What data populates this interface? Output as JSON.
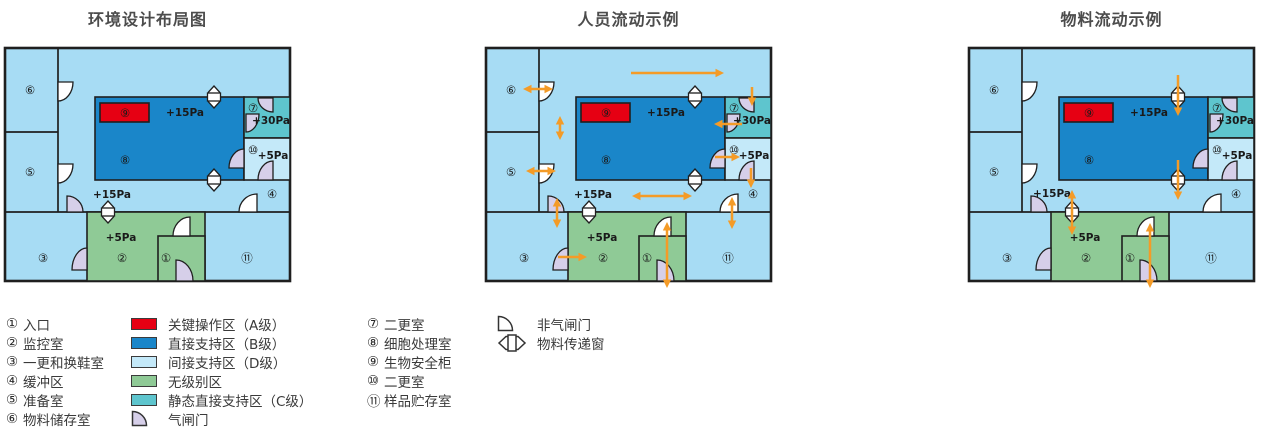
{
  "diagrams": [
    {
      "title": "环境设计布局图",
      "arrows": [],
      "overrides": {}
    },
    {
      "title": "人员流动示例",
      "arrows": [
        [
          145,
          25,
          238,
          25,
          "end"
        ],
        [
          37,
          41,
          67,
          41,
          "both"
        ],
        [
          74,
          68,
          74,
          92,
          "both"
        ],
        [
          40,
          123,
          70,
          123,
          "both"
        ],
        [
          266,
          39,
          266,
          58,
          "end"
        ],
        [
          256,
          76,
          228,
          76,
          "end"
        ],
        [
          229,
          109,
          254,
          109,
          "end"
        ],
        [
          265,
          120,
          265,
          140,
          "end"
        ],
        [
          146,
          148,
          206,
          148,
          "both"
        ],
        [
          71,
          150,
          71,
          180,
          "both"
        ],
        [
          72,
          209,
          101,
          209,
          "end"
        ],
        [
          181,
          174,
          181,
          240,
          "both"
        ],
        [
          246,
          149,
          246,
          181,
          "both"
        ]
      ],
      "overrides": {}
    },
    {
      "title": "物料流动示例",
      "arrows": [
        [
          209,
          27,
          209,
          68,
          "end"
        ],
        [
          209,
          112,
          209,
          152,
          "end"
        ],
        [
          103,
          142,
          103,
          187,
          "both"
        ],
        [
          181,
          175,
          181,
          240,
          "both"
        ]
      ],
      "overrides": {
        "pcorr": {
          "x": 83,
          "y": 146
        }
      }
    }
  ],
  "colors": {
    "red": "#e60013",
    "blue": "#1a86c9",
    "lightblue": "#a7dcf4",
    "paleblue": "#c4e9f9",
    "green": "#8fca96",
    "teal": "#5ec5ce",
    "airlock": "#d6cfe9",
    "plain": "#ffffff",
    "orange": "#f49b27",
    "line": "#1f1f1f",
    "text": "#1a1a1a"
  },
  "floorplan": {
    "base": {
      "w": 285,
      "h": 233
    },
    "walls": [
      [
        53,
        0,
        53,
        164
      ],
      [
        0,
        84,
        53,
        84
      ],
      [
        0,
        164,
        285,
        164
      ]
    ],
    "zones": [
      {
        "name": "room-2-monitoring",
        "x": 82,
        "y": 164,
        "w": 118,
        "h": 69,
        "fill": "green"
      },
      {
        "name": "room-1-entrance",
        "x": 153,
        "y": 188,
        "w": 47,
        "h": 45,
        "fill": "green"
      },
      {
        "name": "room-8-cell-processing",
        "x": 90,
        "y": 49,
        "w": 149,
        "h": 83,
        "fill": "blue"
      },
      {
        "name": "room-7-second-change",
        "x": 239,
        "y": 49,
        "w": 46,
        "h": 41,
        "fill": "teal"
      },
      {
        "name": "room-10-second-change",
        "x": 239,
        "y": 90,
        "w": 46,
        "h": 42,
        "fill": "paleblue"
      },
      {
        "name": "biosafety-cabinet-9",
        "x": 95,
        "y": 55,
        "w": 49,
        "h": 19,
        "fill": "red"
      }
    ],
    "doors": [
      {
        "name": "door-room6",
        "x": 53,
        "y": 34,
        "w": 15,
        "h": 19,
        "hinge": "tl",
        "type": "plain"
      },
      {
        "name": "door-room5",
        "x": 53,
        "y": 116,
        "w": 15,
        "h": 19,
        "hinge": "tl",
        "type": "plain"
      },
      {
        "name": "door-corridor-room3",
        "x": 62,
        "y": 148,
        "w": 16,
        "h": 16,
        "hinge": "bl",
        "type": "airlock"
      },
      {
        "name": "door-room8-room10",
        "x": 224,
        "y": 101,
        "w": 15,
        "h": 19,
        "hinge": "br",
        "type": "airlock"
      },
      {
        "name": "door-room7-top",
        "x": 253,
        "y": 50,
        "w": 15,
        "h": 14,
        "hinge": "tr",
        "type": "airlock"
      },
      {
        "name": "door-room7-left",
        "x": 241,
        "y": 66,
        "w": 13,
        "h": 18,
        "hinge": "tl",
        "type": "airlock"
      },
      {
        "name": "door-room10",
        "x": 253,
        "y": 113,
        "w": 15,
        "h": 19,
        "hinge": "br",
        "type": "airlock"
      },
      {
        "name": "door-corridor-room11",
        "x": 234,
        "y": 146,
        "w": 18,
        "h": 18,
        "hinge": "br",
        "type": "plain"
      },
      {
        "name": "door-room3-room2",
        "x": 67,
        "y": 200,
        "w": 15,
        "h": 22,
        "hinge": "br",
        "type": "airlock"
      },
      {
        "name": "door-room1-top",
        "x": 168,
        "y": 169,
        "w": 17,
        "h": 19,
        "hinge": "br",
        "type": "plain"
      },
      {
        "name": "door-room1-bottom",
        "x": 171,
        "y": 212,
        "w": 17,
        "h": 21,
        "hinge": "bl",
        "type": "airlock"
      }
    ],
    "windows": [
      {
        "name": "pass-window-room8-top",
        "cx": 209,
        "cy": 49
      },
      {
        "name": "pass-window-room8-bottom",
        "cx": 209,
        "cy": 132
      },
      {
        "name": "pass-window-room2",
        "cx": 103,
        "cy": 164
      }
    ],
    "room_numbers": [
      {
        "t": "⑥",
        "x": 25,
        "y": 42
      },
      {
        "t": "⑤",
        "x": 25,
        "y": 124
      },
      {
        "t": "③",
        "x": 38,
        "y": 210
      },
      {
        "t": "②",
        "x": 117,
        "y": 210
      },
      {
        "t": "①",
        "x": 161,
        "y": 210
      },
      {
        "t": "⑪",
        "x": 242,
        "y": 210
      },
      {
        "t": "⑧",
        "x": 120,
        "y": 112
      },
      {
        "t": "⑨",
        "x": 120,
        "y": 65
      },
      {
        "t": "⑦",
        "x": 248,
        "y": 60
      },
      {
        "t": "⑩",
        "x": 248,
        "y": 102
      },
      {
        "t": "④",
        "x": 267,
        "y": 146
      }
    ],
    "pressures": [
      {
        "id": "p8",
        "t": "+15Pa",
        "x": 180,
        "y": 65
      },
      {
        "id": "p7",
        "t": "+30Pa",
        "x": 266,
        "y": 73
      },
      {
        "id": "p10",
        "t": "+5Pa",
        "x": 268,
        "y": 108
      },
      {
        "id": "pcorr",
        "t": "+15Pa",
        "x": 107,
        "y": 147
      },
      {
        "id": "p2",
        "t": "+5Pa",
        "x": 116,
        "y": 190
      }
    ]
  },
  "legend": {
    "rooms_col1": [
      {
        "num": "①",
        "label": "入口"
      },
      {
        "num": "②",
        "label": "监控室"
      },
      {
        "num": "③",
        "label": "一更和换鞋室"
      },
      {
        "num": "④",
        "label": "缓冲区"
      },
      {
        "num": "⑤",
        "label": "准备室"
      },
      {
        "num": "⑥",
        "label": "物料储存室"
      }
    ],
    "zones": [
      {
        "swatch": "red",
        "label": "关键操作区（A级）"
      },
      {
        "swatch": "blue",
        "label": "直接支持区（B级）"
      },
      {
        "swatch": "paleblue",
        "label": "间接支持区（D级）"
      },
      {
        "swatch": "green",
        "label": "无级别区"
      },
      {
        "swatch": "teal",
        "label": "静态直接支持区（C级）"
      },
      {
        "icon": "airlock-door",
        "label": "气闸门"
      }
    ],
    "rooms_col2": [
      {
        "num": "⑦",
        "label": "二更室"
      },
      {
        "num": "⑧",
        "label": "细胞处理室"
      },
      {
        "num": "⑨",
        "label": "生物安全柜"
      },
      {
        "num": "⑩",
        "label": "二更室"
      },
      {
        "num": "⑪",
        "label": "样品贮存室"
      }
    ],
    "symbols": [
      {
        "icon": "plain-door",
        "label": "非气闸门"
      },
      {
        "icon": "pass-window",
        "label": "物料传递窗"
      }
    ]
  }
}
